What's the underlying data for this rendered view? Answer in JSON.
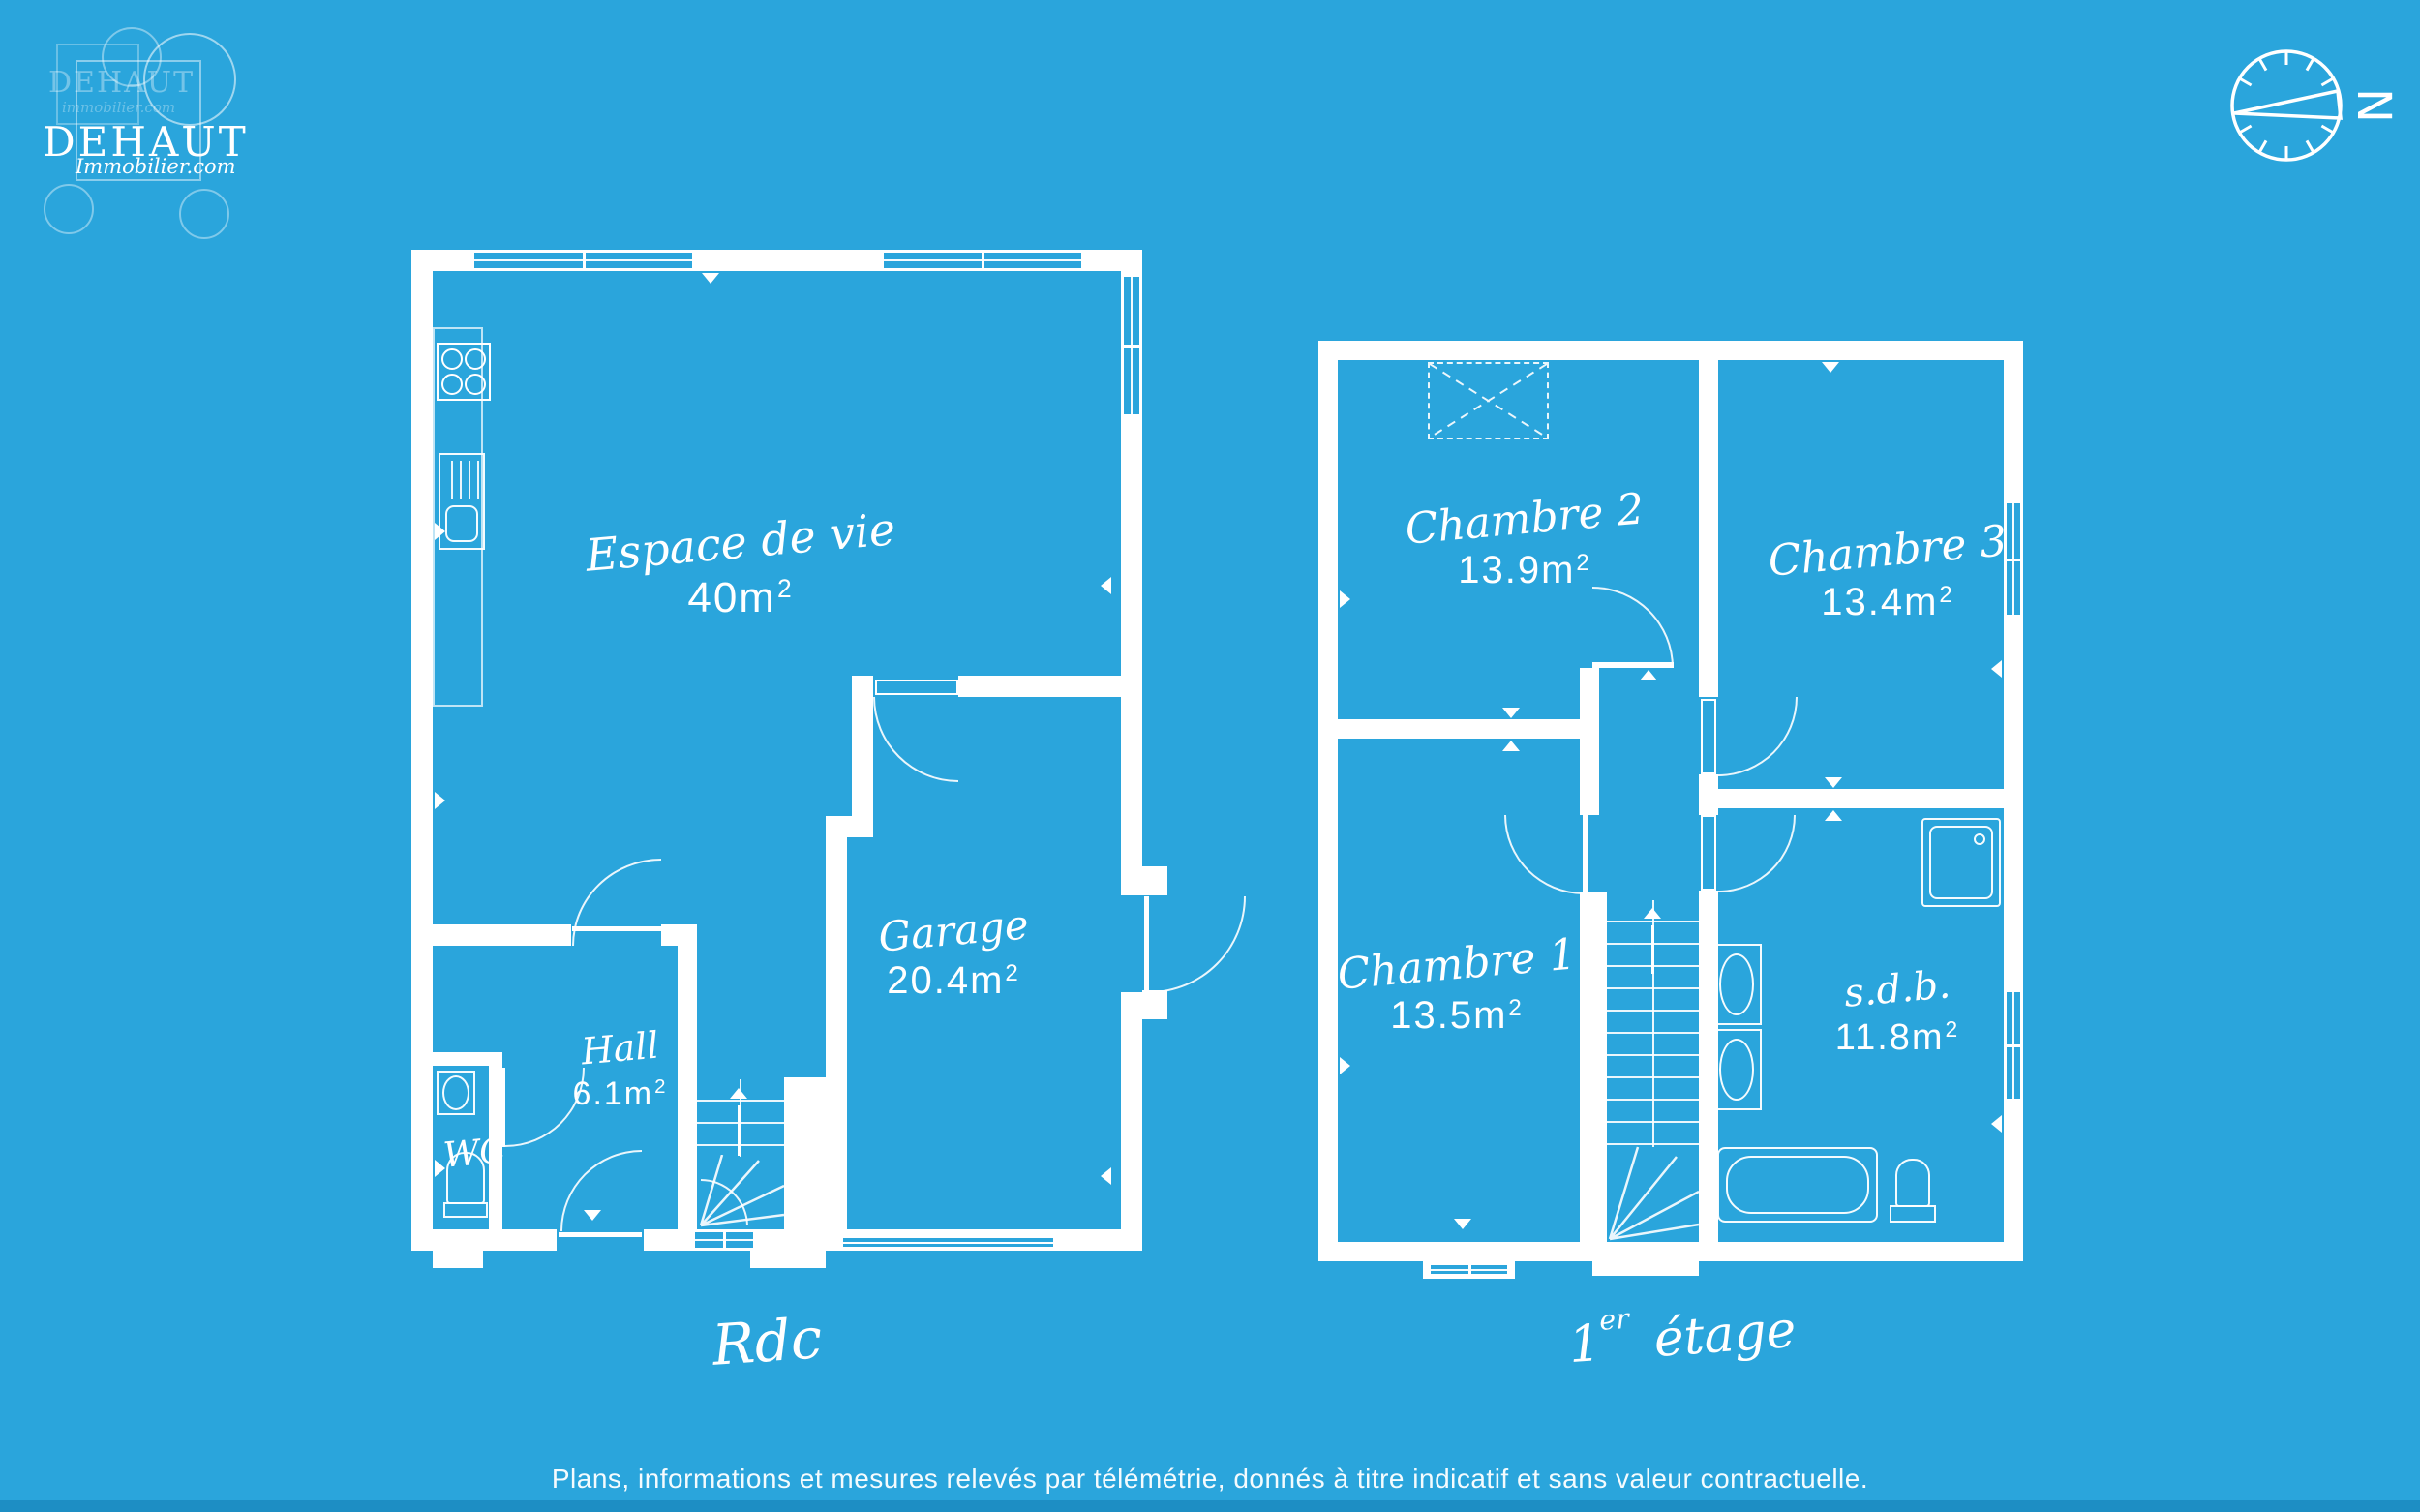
{
  "page": {
    "background_color": "#2aa5dc",
    "wall_color": "#ffffff",
    "footer_bar_color": "#1d8ec4",
    "disclaimer": "Plans, informations et mesures relevés par télémétrie, donnés à titre indicatif et sans valeur contractuelle."
  },
  "logo": {
    "brand": "DEHAUT",
    "brand_sub": "Immobilier.com",
    "brand_faint": "DEHAUT",
    "brand_faint_sub": "immobilier.com"
  },
  "compass": {
    "north": "N"
  },
  "floors": {
    "rdc": {
      "label": "Rdc",
      "rooms": {
        "living": {
          "name": "Espace de vie",
          "area": "40m",
          "area_sup": "2"
        },
        "garage": {
          "name": "Garage",
          "area": "20.4m",
          "area_sup": "2"
        },
        "hall": {
          "name": "Hall",
          "area": "6.1m",
          "area_sup": "2"
        },
        "wc": {
          "name": "WC"
        }
      }
    },
    "etage": {
      "label_num": "1",
      "label_sup": "er",
      "label_rest": "étage",
      "rooms": {
        "chambre2": {
          "name": "Chambre 2",
          "area": "13.9m",
          "area_sup": "2"
        },
        "chambre3": {
          "name": "Chambre 3",
          "area": "13.4m",
          "area_sup": "2"
        },
        "chambre1": {
          "name": "Chambre 1",
          "area": "13.5m",
          "area_sup": "2"
        },
        "sdb": {
          "name": "s.d.b.",
          "area": "11.8m",
          "area_sup": "2"
        }
      }
    }
  }
}
